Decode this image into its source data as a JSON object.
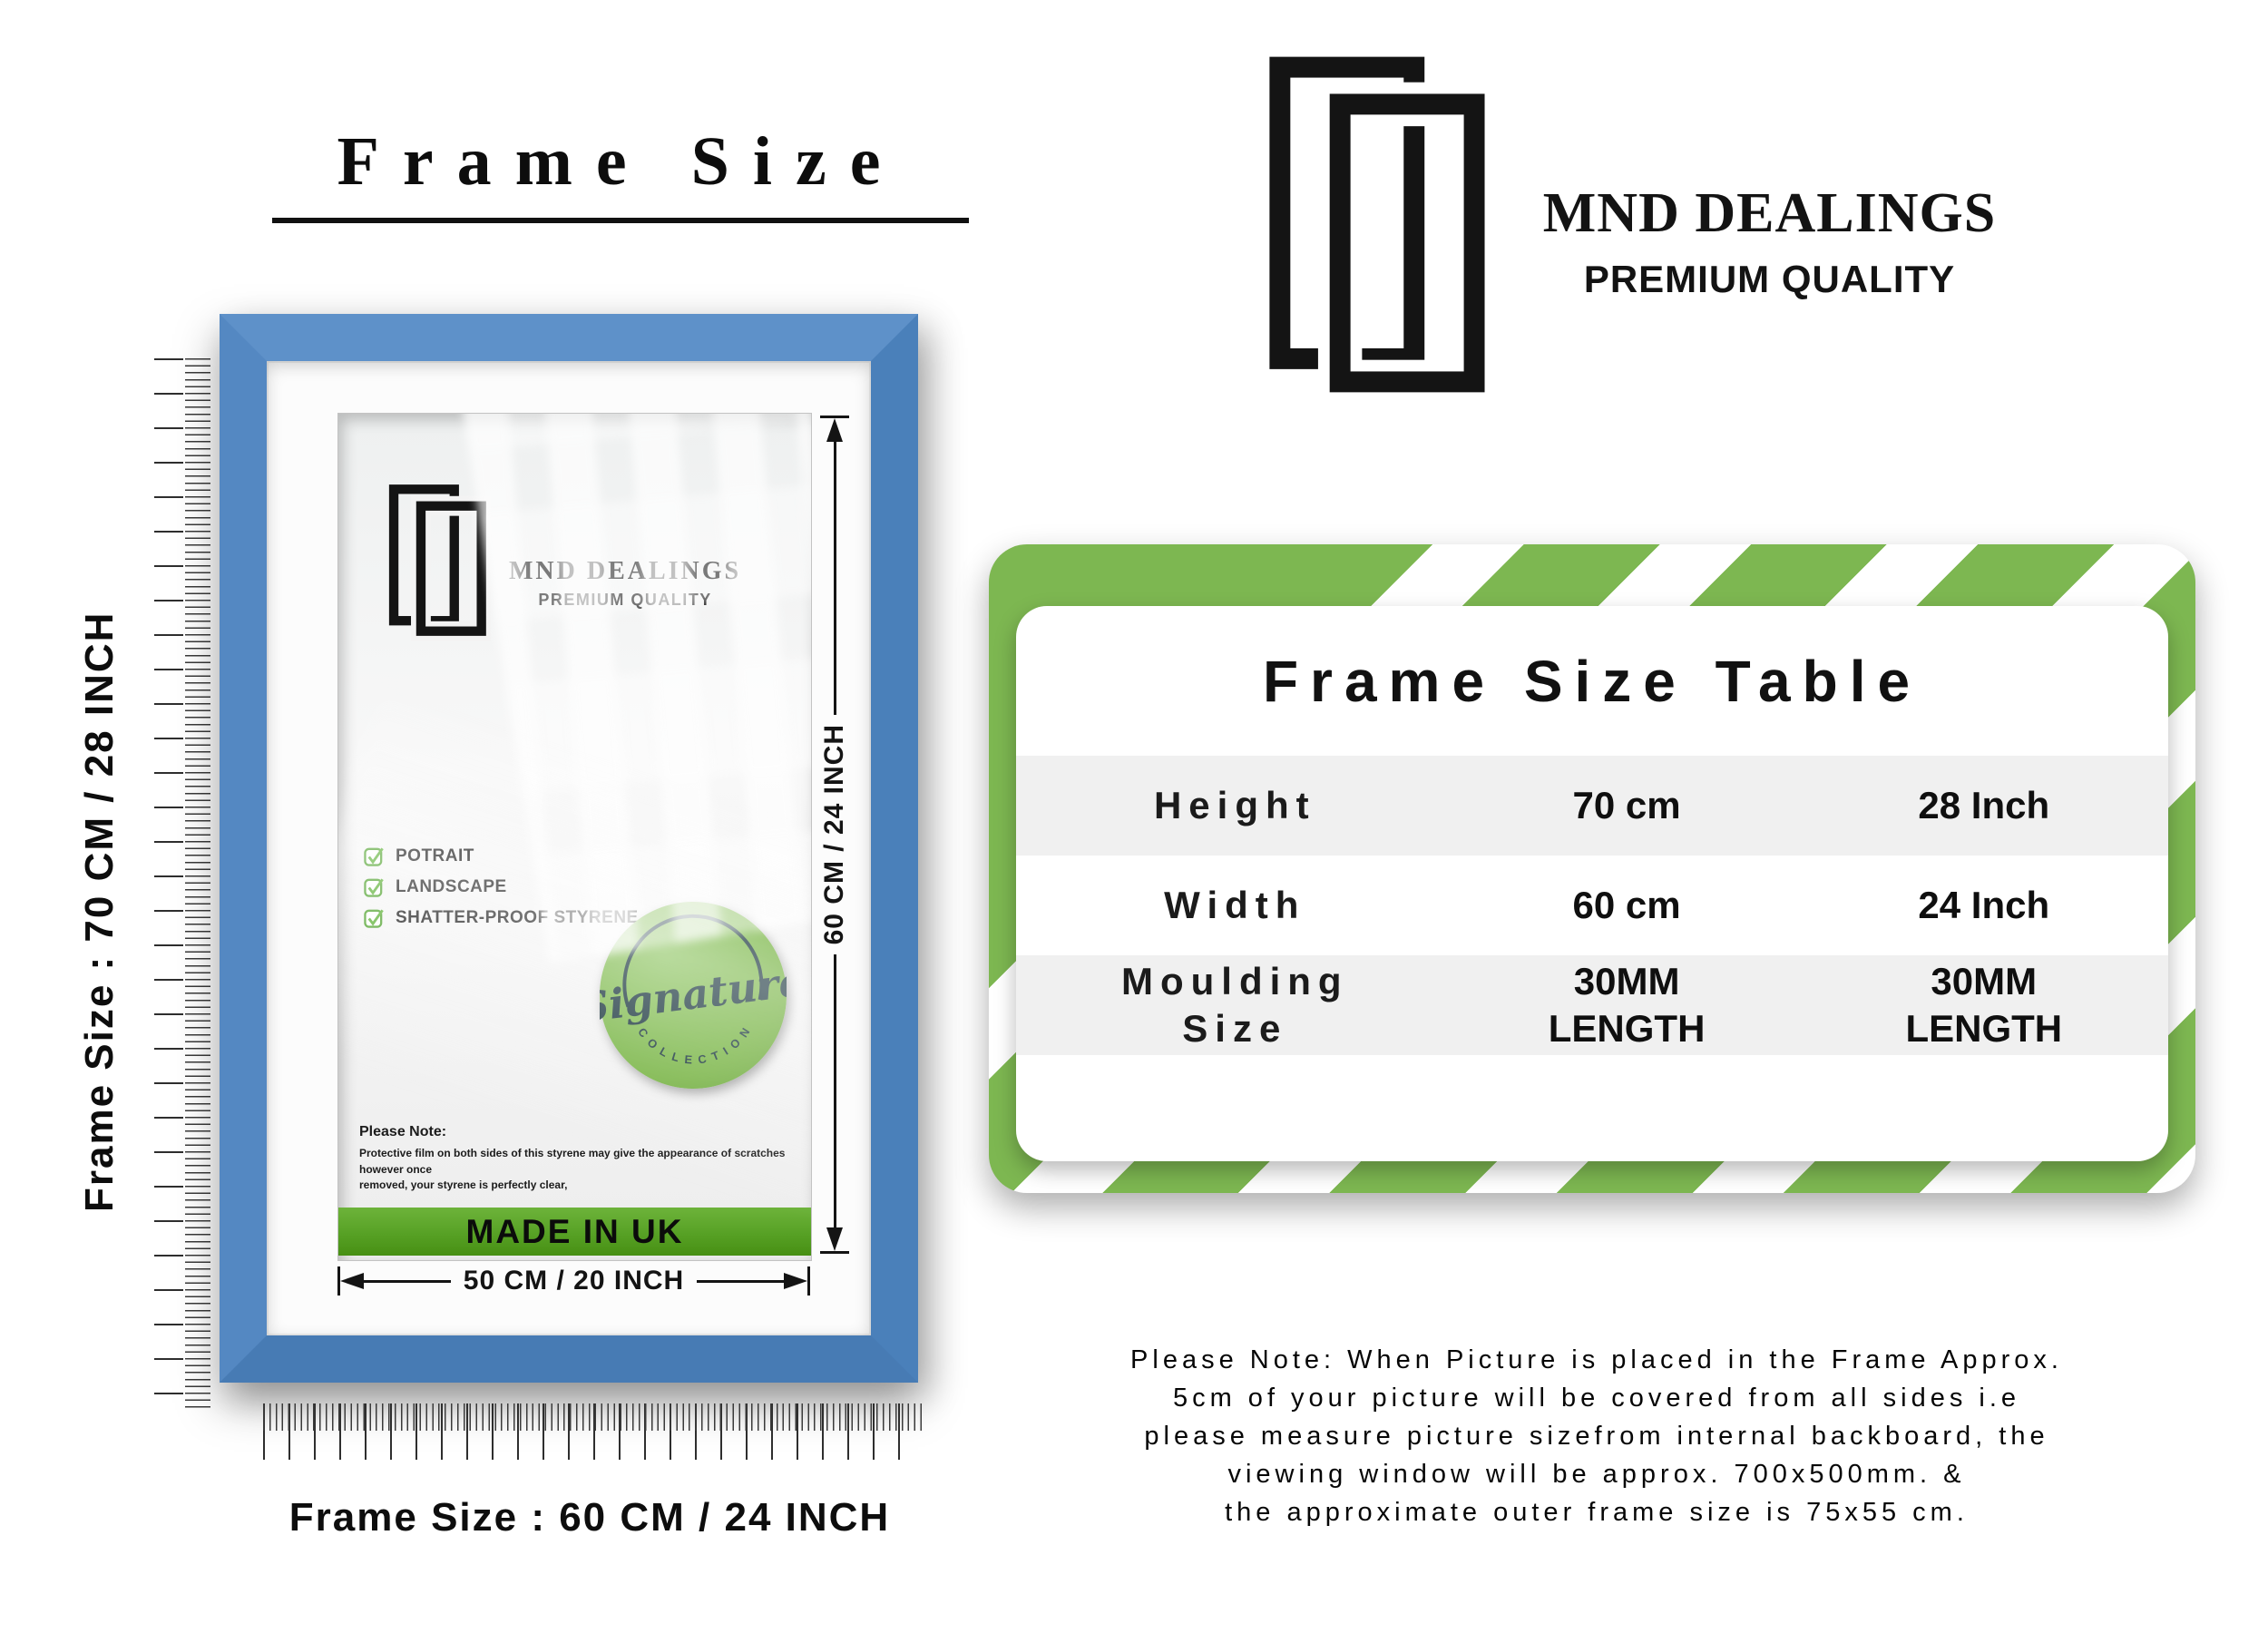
{
  "title": "Frame Size",
  "left": {
    "vertical_label": "Frame Size : 70 CM / 28 INCH",
    "bottom_label": "Frame Size : 60 CM / 24 INCH",
    "frame": {
      "logo_name": "MND DEALINGS",
      "logo_tagline": "PREMIUM QUALITY",
      "features": [
        "POTRAIT",
        "LANDSCAPE",
        "SHATTER-PROOF STYRENE"
      ],
      "badge_script": "Signature",
      "badge_arc": "C O L L E C T I O N",
      "note_heading": "Please Note:",
      "note_line1": "Protective film on both sides of this styrene may give the appearance of scratches however once",
      "note_line2": "removed, your styrene is perfectly clear,",
      "made_in": "MADE IN UK",
      "width_dim": "50 CM / 20 INCH",
      "height_dim": "60 CM / 24 INCH"
    }
  },
  "header": {
    "logo_name": "MND DEALINGS",
    "logo_tagline": "PREMIUM QUALITY"
  },
  "table": {
    "title": "Frame Size Table",
    "rows": [
      {
        "label": "Height",
        "cm": "70 cm",
        "inch": "28 Inch"
      },
      {
        "label": "Width",
        "cm": "60 cm",
        "inch": "24 Inch"
      },
      {
        "label": "Moulding Size",
        "cm": "30MM LENGTH",
        "inch": "30MM LENGTH"
      }
    ]
  },
  "note_lines": [
    "Please Note: When Picture is placed in the Frame Approx.",
    "5cm of your picture will be covered from all sides i.e",
    "please measure picture sizefrom internal backboard, the",
    "viewing window will be approx. 700x500mm. &",
    "the approximate outer frame size is 75x55 cm."
  ],
  "colors": {
    "frame_blue": "#4f86c0",
    "brand_green": "#57a125",
    "stripe_green": "#7db751",
    "badge_green": "#74b23f",
    "row_gray": "#f0f0f0",
    "ink": "#141414"
  }
}
